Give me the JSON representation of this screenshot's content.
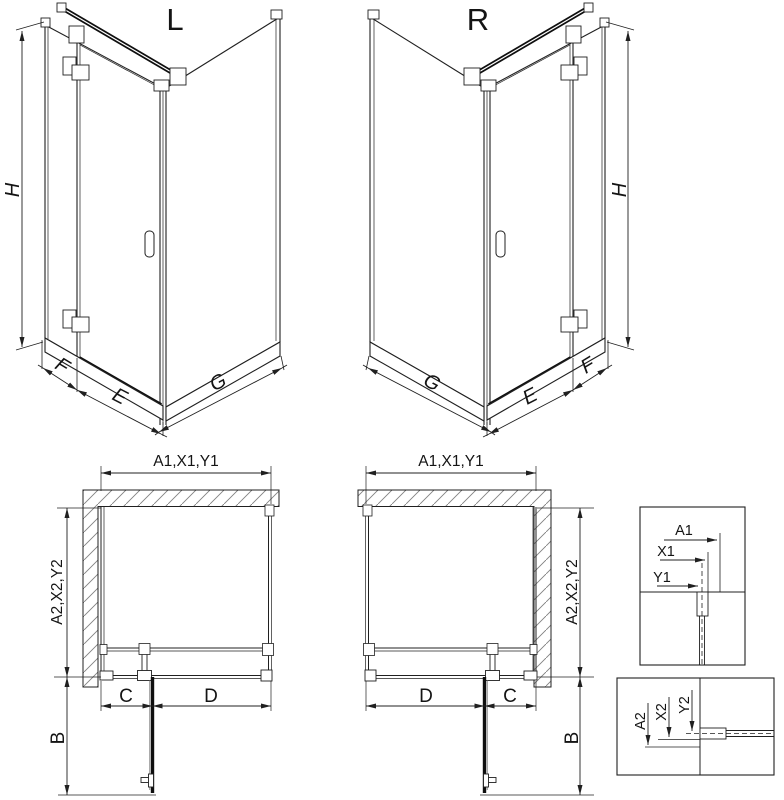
{
  "colors": {
    "line": "#202020",
    "bold_line": "#0f0f0f",
    "hatch": "#808080",
    "background": "#ffffff"
  },
  "iso_left": {
    "label": "L",
    "dim_height": "H",
    "dim_fixed_return": "F",
    "dim_door_width": "E",
    "dim_side_panel": "G"
  },
  "iso_right": {
    "label": "R",
    "dim_height": "H",
    "dim_fixed_return": "F",
    "dim_door_width": "E",
    "dim_side_panel": "G"
  },
  "plan_left": {
    "dim_top_width": "A1,X1,Y1",
    "dim_side_depth": "A2,X2,Y2",
    "dim_c": "C",
    "dim_d": "D",
    "dim_door_swing": "B"
  },
  "plan_right": {
    "dim_top_width": "A1,X1,Y1",
    "dim_side_depth": "A2,X2,Y2",
    "dim_c": "C",
    "dim_d": "D",
    "dim_door_swing": "B"
  },
  "detail_top": {
    "dim_a1": "A1",
    "dim_x1": "X1",
    "dim_y1": "Y1"
  },
  "detail_bottom": {
    "dim_a2": "A2",
    "dim_x2": "X2",
    "dim_y2": "Y2"
  }
}
